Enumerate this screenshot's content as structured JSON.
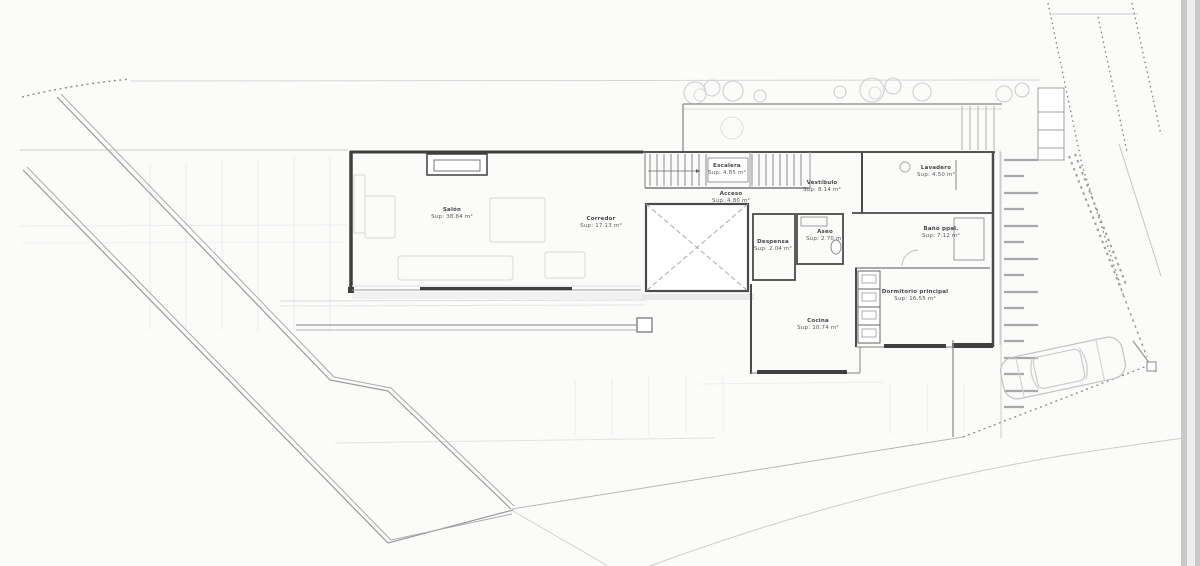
{
  "drawing": {
    "kind_label": "Planta - vivienda unifamiliar",
    "palette": {
      "paper": "#fbfbfa",
      "wall_dark": "#3f3f3f",
      "wall_medium": "#555555",
      "line_gray": "#9a9a9a",
      "line_faint": "#dedede",
      "photo_border": "#c9c9c9"
    }
  },
  "rooms": {
    "salon": {
      "name": "Salón",
      "area": "Sup: 38.64 m²"
    },
    "corredor": {
      "name": "Corredor",
      "area": "Sup: 17.13 m²"
    },
    "escalera": {
      "name": "Escalera",
      "area": "Sup: 4.85 m²"
    },
    "acceso": {
      "name": "Acceso",
      "area": "Sup: 4.80 m²"
    },
    "vestibulo": {
      "name": "Vestíbulo",
      "area": "Sup: 8.14 m²"
    },
    "lavadero": {
      "name": "Lavadero",
      "area": "Sup: 4.50 m²"
    },
    "banio": {
      "name": "Baño ppal.",
      "area": "Sup: 7.12 m²"
    },
    "dormitorio": {
      "name": "Dormitorio principal",
      "area": "Sup: 16.55 m²"
    },
    "despensa": {
      "name": "Despensa",
      "area": "Sup: 2.04 m²"
    },
    "aseo": {
      "name": "Aseo",
      "area": "Sup: 2.70 m²"
    },
    "cocina": {
      "name": "Cocina",
      "area": "Sup: 10.74 m²"
    }
  }
}
